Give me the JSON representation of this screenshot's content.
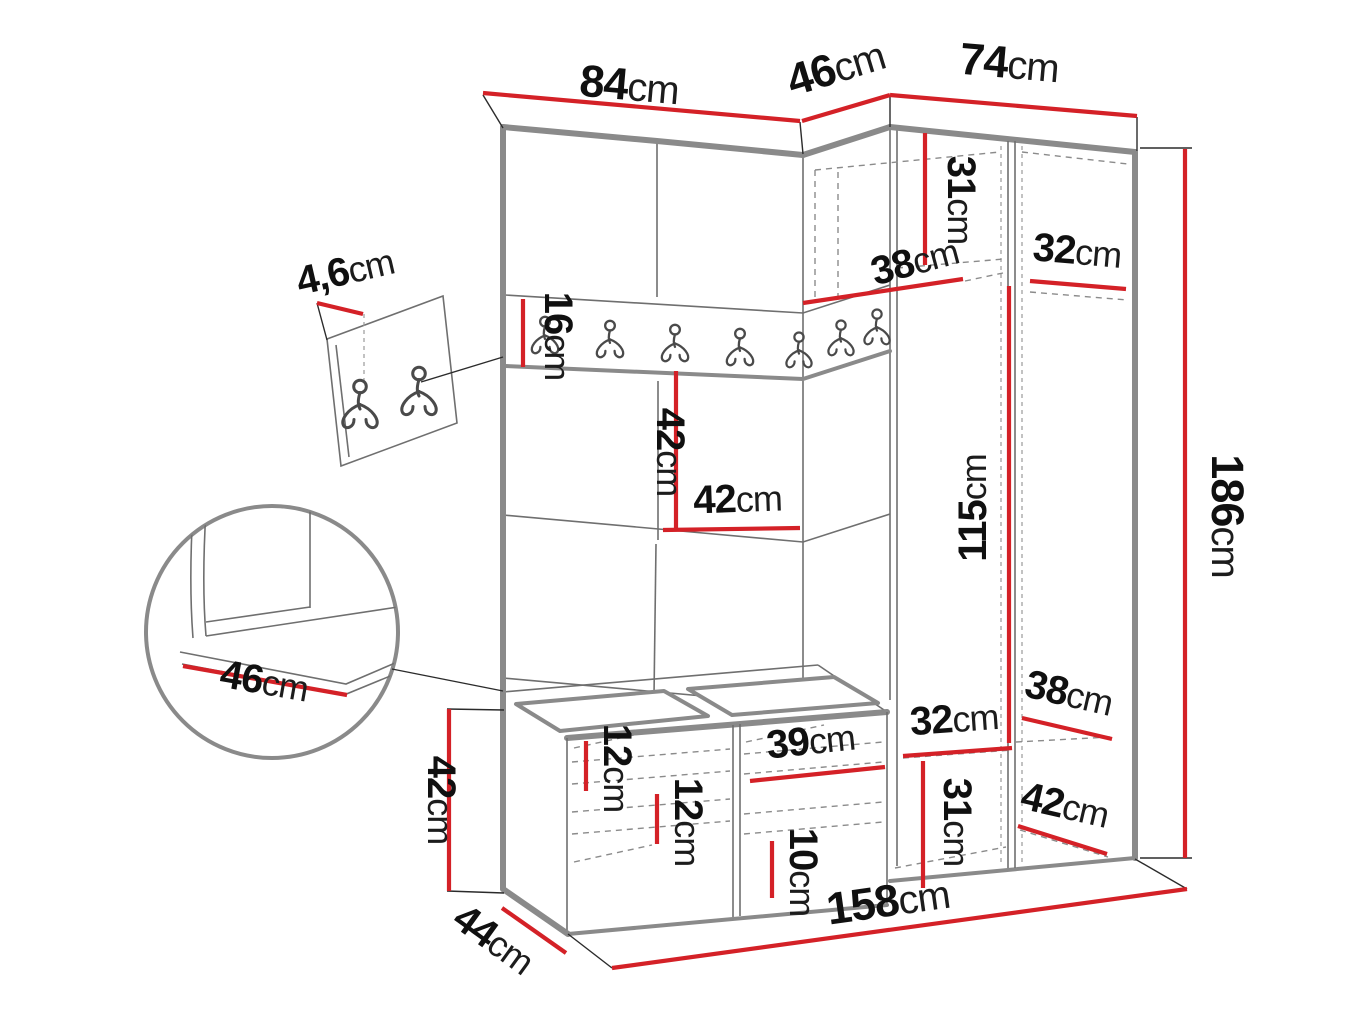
{
  "title": "Hallway wardrobe set technical drawing with dimensions",
  "units": "cm",
  "colors": {
    "dimension_line": "#d42127",
    "furniture_edge": "#8a8a8a",
    "thin_line": "#6f6f6f",
    "hidden_dashed_line": "#8b8b8b",
    "label_text": "#101010",
    "background": "#ffffff"
  },
  "dimensions": {
    "top_width_left": {
      "num": "84",
      "unit": "cm"
    },
    "top_width_corner": {
      "num": "46",
      "unit": "cm"
    },
    "top_width_right": {
      "num": "74",
      "unit": "cm"
    },
    "upper_shelf_height": {
      "num": "31",
      "unit": "cm"
    },
    "upper_shelf_depth": {
      "num": "38",
      "unit": "cm"
    },
    "upper_right_shelf": {
      "num": "32",
      "unit": "cm"
    },
    "hook_rail_height": {
      "num": "16",
      "unit": "cm"
    },
    "mid_panel_height": {
      "num": "42",
      "unit": "cm"
    },
    "mid_panel_width": {
      "num": "42",
      "unit": "cm"
    },
    "interior_height": {
      "num": "115",
      "unit": "cm"
    },
    "total_height": {
      "num": "186",
      "unit": "cm"
    },
    "wall_panel_thickness": {
      "num": "4,6",
      "unit": "cm"
    },
    "seat_depth_detail": {
      "num": "46",
      "unit": "cm"
    },
    "bench_height": {
      "num": "42",
      "unit": "cm"
    },
    "bench_depth": {
      "num": "44",
      "unit": "cm"
    },
    "shoe_shelf_gap_left": {
      "num": "12",
      "unit": "cm"
    },
    "shoe_shelf_gap_mid": {
      "num": "12",
      "unit": "cm"
    },
    "bench_niche_width": {
      "num": "39",
      "unit": "cm"
    },
    "bottom_shelf_gap": {
      "num": "10",
      "unit": "cm"
    },
    "lower_shelf_height": {
      "num": "31",
      "unit": "cm"
    },
    "lower_shelf_width": {
      "num": "32",
      "unit": "cm"
    },
    "lower_shelf_depth": {
      "num": "38",
      "unit": "cm"
    },
    "lower_right_depth": {
      "num": "42",
      "unit": "cm"
    },
    "total_width": {
      "num": "158",
      "unit": "cm"
    }
  }
}
